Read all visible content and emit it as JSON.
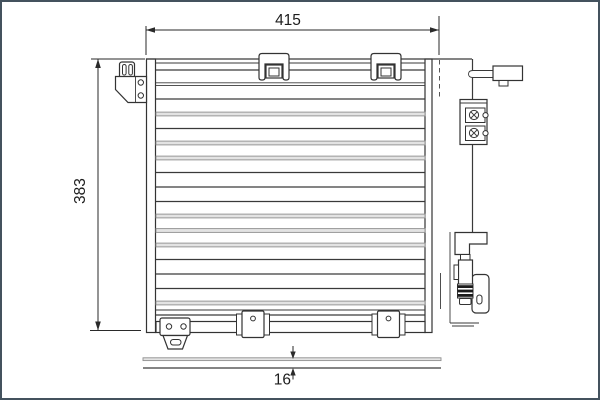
{
  "page": {
    "background": "#ffffff",
    "frame_border_color": "#44525e"
  },
  "diagram": {
    "type": "technical part drawing",
    "subject": "air-conditioning condenser, front view with side (thickness) view",
    "line_color": "#333333",
    "gray_band_color": "#e3e3e3",
    "dimensions": {
      "width_mm": "415",
      "height_mm": "383",
      "depth_mm": "16"
    }
  }
}
